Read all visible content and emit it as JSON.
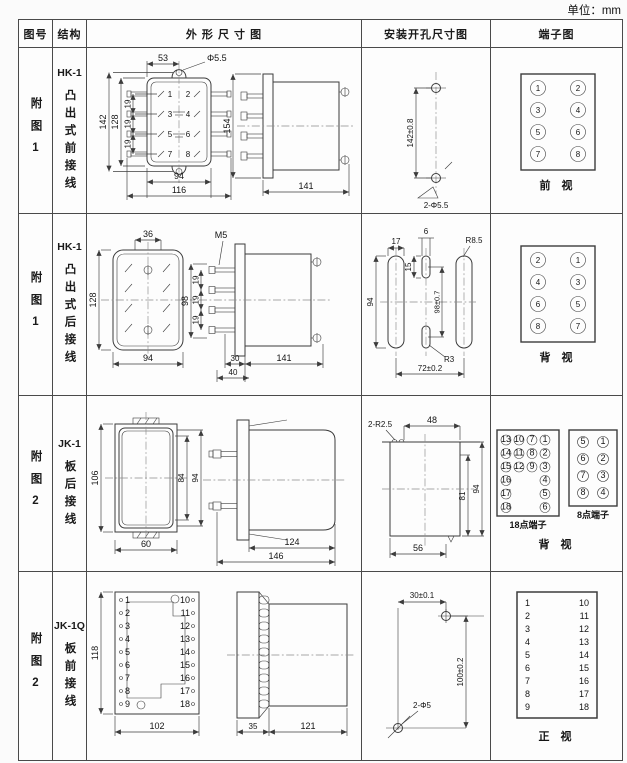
{
  "unit_note": "单位：mm",
  "header": {
    "figure": "图号",
    "structure": "结构",
    "outline": "外 形 尺 寸 图",
    "mounting": "安装开孔尺寸图",
    "terminal": "端子图"
  },
  "rows": [
    {
      "figure": "附图1",
      "model": "HK-1",
      "desc": "凸出式前接线",
      "outline": {
        "d53": "53",
        "hole": "Φ5.5",
        "d142": "142",
        "d128": "128",
        "d19": "19",
        "d94": "94",
        "d116": "116",
        "d154": "154",
        "d141": "141",
        "t": [
          "1",
          "2",
          "3",
          "4",
          "5",
          "6",
          "7",
          "8"
        ]
      },
      "mounting": {
        "dv": "142±0.8",
        "holes": "2-Φ5.5"
      },
      "terminal": {
        "caption": "前  视",
        "left": [
          "1",
          "3",
          "5",
          "7"
        ],
        "right": [
          "2",
          "4",
          "6",
          "8"
        ]
      }
    },
    {
      "figure": "附图1",
      "model": "HK-1",
      "desc": "凸出式后接线",
      "outline": {
        "d36": "36",
        "d128": "128",
        "d94": "94",
        "m5": "M5",
        "d98": "98",
        "d19": "19",
        "d30": "30",
        "d40": "40",
        "d141": "141"
      },
      "mounting": {
        "d17": "17",
        "d6": "6",
        "d15": "15",
        "d94": "94",
        "dv": "98±0.7",
        "r85": "R8.5",
        "r3": "R3",
        "d72": "72±0.2"
      },
      "terminal": {
        "caption": "背  视",
        "left": [
          "2",
          "4",
          "6",
          "8"
        ],
        "right": [
          "1",
          "3",
          "5",
          "7"
        ]
      }
    },
    {
      "figure": "附图2",
      "model": "JK-1",
      "desc": "板后接线",
      "outline": {
        "d106": "106",
        "d84": "84",
        "d94": "94",
        "d60": "60",
        "d124": "124",
        "d146": "146"
      },
      "mounting": {
        "r": "2-R2.5",
        "d48": "48",
        "d81": "81",
        "d94": "94",
        "d56": "56"
      },
      "terminal": {
        "label18": "18点端子",
        "label8": "8点端子",
        "caption": "背  视",
        "c1": [
          "13",
          "14",
          "15",
          "16",
          "17",
          "18"
        ],
        "c2": [
          "10",
          "11",
          "12"
        ],
        "c3": [
          "7",
          "8",
          "9"
        ],
        "c4": [
          "1",
          "2",
          "3",
          "4",
          "5",
          "6"
        ],
        "e_left": [
          "5",
          "6",
          "7",
          "8"
        ],
        "e_right": [
          "1",
          "2",
          "3",
          "4"
        ]
      }
    },
    {
      "figure": "附图2",
      "model": "JK-1Q",
      "desc": "板前接线",
      "outline": {
        "d118": "118",
        "d102": "102",
        "d35": "35",
        "d121": "121",
        "left": [
          "1",
          "2",
          "3",
          "4",
          "5",
          "6",
          "7",
          "8",
          "9"
        ],
        "right": [
          "10",
          "11",
          "12",
          "13",
          "14",
          "15",
          "16",
          "17",
          "18"
        ]
      },
      "mounting": {
        "dh": "30±0.1",
        "dv": "100±0.2",
        "holes": "2-Φ5"
      },
      "terminal": {
        "caption": "正  视",
        "left": [
          "1",
          "2",
          "3",
          "4",
          "5",
          "6",
          "7",
          "8",
          "9"
        ],
        "right": [
          "10",
          "11",
          "12",
          "13",
          "14",
          "15",
          "16",
          "17",
          "18"
        ]
      }
    }
  ]
}
